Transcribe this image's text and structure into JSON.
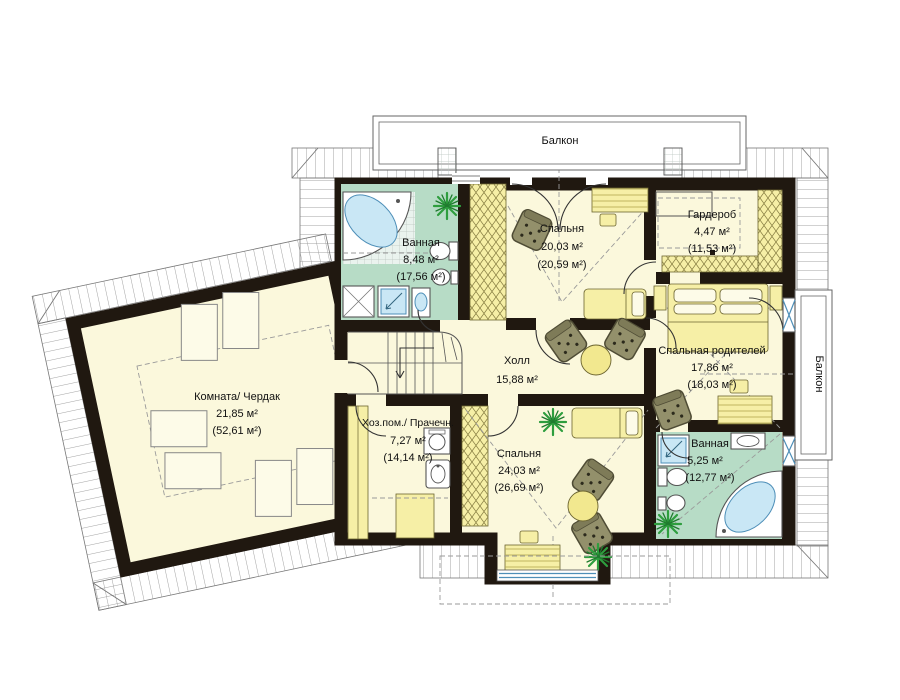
{
  "plan": {
    "balcony_top": "Балкон",
    "balcony_right": "Балкон",
    "rooms": {
      "bathroom_top": {
        "name": "Ванная",
        "area": "8,48 м²",
        "total": "(17,56 м²)"
      },
      "bedroom_20": {
        "name": "Спальня",
        "area": "20,03 м²",
        "total": "(20,59 м²)"
      },
      "wardrobe": {
        "name": "Гардероб",
        "area": "4,47 м²",
        "total": "(11,53 м²)"
      },
      "parents_bedroom": {
        "name": "Спальная родителей",
        "area": "17,86 м²",
        "total": "(18,03 м²)"
      },
      "hall": {
        "name": "Холл",
        "area": "15,88 м²"
      },
      "attic_room": {
        "name": "Комната/ Чердак",
        "area": "21,85 м²",
        "total": "(52,61 м²)"
      },
      "utility": {
        "name": "Хоз.пом./ Прачечн.",
        "area": "7,27 м²",
        "total": "(14,14 м²)"
      },
      "bedroom_24": {
        "name": "Спальня",
        "area": "24,03 м²",
        "total": "(26,69 м²)"
      },
      "bathroom_bottom": {
        "name": "Ванная",
        "area": "5,25 м²",
        "total": "(12,77 м²)"
      }
    },
    "colors": {
      "wall": "#201810",
      "floor": "#FBF8DC",
      "bath_floor": "#B7DCC6",
      "furniture_yellow": "#F6EFA6",
      "fixture_blue": "#C9E7F5",
      "armchair_olive": "#93906B",
      "plant_green": "#2E9E3E"
    }
  }
}
